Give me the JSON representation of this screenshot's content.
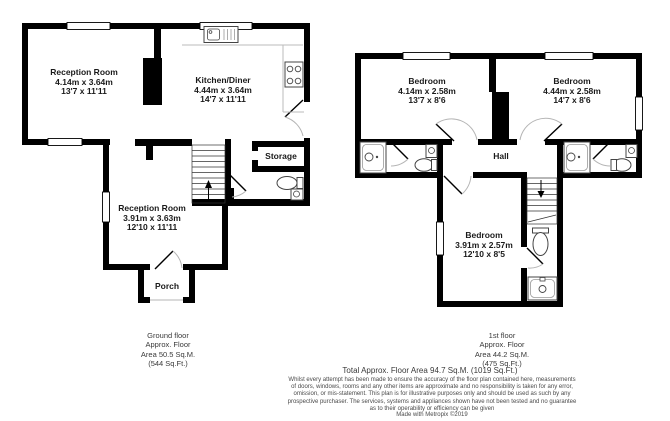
{
  "ground_floor": {
    "rooms": [
      {
        "name": "Reception Room",
        "metric": "4.14m x 3.64m",
        "imperial": "13'7 x 11'11"
      },
      {
        "name": "Kitchen/Diner",
        "metric": "4.44m x 3.64m",
        "imperial": "14'7 x 11'11"
      },
      {
        "name": "Reception Room",
        "metric": "3.91m x 3.63m",
        "imperial": "12'10 x 11'11"
      },
      {
        "name": "Storage"
      },
      {
        "name": "Porch"
      }
    ],
    "caption": {
      "lines": [
        "Ground floor",
        "Approx. Floor",
        "Area 50.5 Sq.M.",
        "(544 Sq.Ft.)"
      ]
    }
  },
  "first_floor": {
    "rooms": [
      {
        "name": "Bedroom",
        "metric": "4.14m x 2.58m",
        "imperial": "13'7 x 8'6"
      },
      {
        "name": "Bedroom",
        "metric": "4.44m x 2.58m",
        "imperial": "14'7 x 8'6"
      },
      {
        "name": "Bedroom",
        "metric": "3.91m x 2.57m",
        "imperial": "12'10 x 8'5"
      },
      {
        "name": "Hall"
      }
    ],
    "caption": {
      "lines": [
        "1st floor",
        "Approx. Floor",
        "Area 44.2 Sq.M.",
        "(475 Sq.Ft.)"
      ]
    }
  },
  "footer": {
    "total": "Total Approx. Floor Area 94.7 Sq.M. (1019 Sq.Ft.)",
    "disclaimer_lines": [
      "Whilst every attempt has been made to ensure the accuracy of the floor plan contained here, measurements",
      "of doors, windows, rooms and any other items are approximate and no responsibility is taken for any error,",
      "omission, or mis-statement. This plan is for illustrative purposes only and should be used as such by any",
      "prospective purchaser. The services, systems and appliances shown have not been tested and no guarantee",
      "as to their operability or efficiency can be given"
    ],
    "credit": "Made with Metropix ©2019"
  },
  "symbols": {
    "stairs_up_arrow": "↑",
    "stairs_down_arrow": "↓"
  },
  "colors": {
    "wall": "#000000",
    "fixture_outline": "#444444",
    "detail_line": "#bbbbbb",
    "room_text": "#1a1a1a",
    "caption_text": "#3a3a3a"
  }
}
